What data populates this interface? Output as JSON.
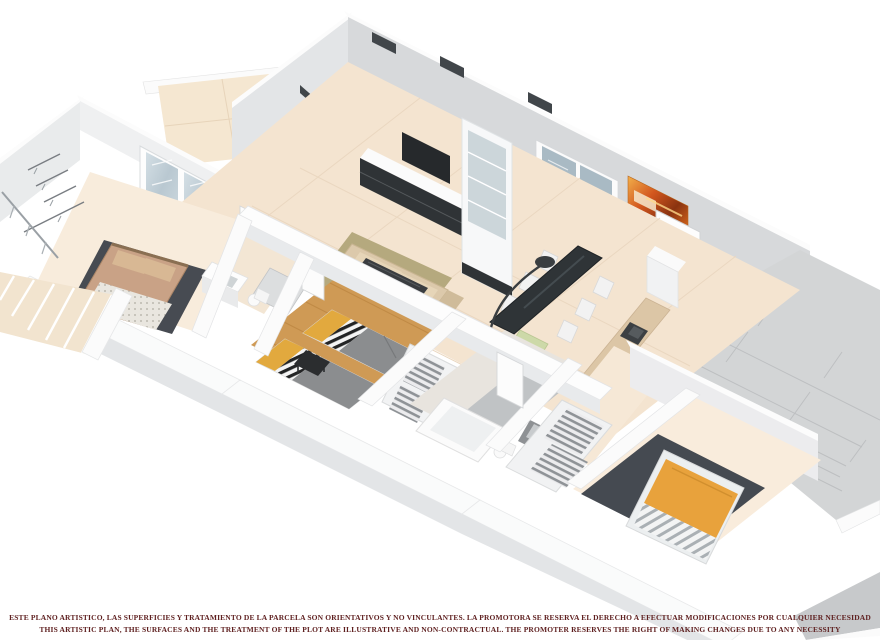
{
  "document": {
    "kind": "3d-isometric-floor-plan-render",
    "background": "#ffffff"
  },
  "disclaimer": {
    "line1_es": "ESTE PLANO ARTISTICO, LAS SUPERFICIES Y TRATAMIENTO DE LA PARCELA SON ORIENTATIVOS Y NO VINCULANTES. LA PROMOTORA SE RESERVA EL DERECHO A EFECTUAR MODIFICACIONES POR CUALQUIER NECESIDAD",
    "line2_en": "THIS ARTISTIC PLAN, THE SURFACES AND THE TREATMENT OF THE PLOT ARE ILLUSTRATIVE AND NON-CONTRACTUAL. THE PROMOTER RESERVES THE RIGHT OF MAKING CHANGES DUE TO ANY NECESSITY",
    "text_color": "#5e1f1f"
  },
  "palette": {
    "wall_face": "#d7d9db",
    "wall_face_light": "#e9ebec",
    "wall_cap": "#fcfcfc",
    "floor_tile_cream": "#f4e4d0",
    "floor_bedroom": "#f8ecdc",
    "floor_wood_orange": "#cf9a55",
    "terrace_gray": "#d3d5d6",
    "rug_dark_gray": "#474b52",
    "duvet_orange": "#e8a23c",
    "pillow_yellow": "#e2a93e",
    "bed_gray": "#8b8d8f",
    "sofa_beige": "#dcc9ab",
    "glass_blue": "#c2cfd7",
    "dark_furniture": "#2f3437",
    "painting_orange": "#d2561e"
  },
  "rooms": [
    {
      "name": "living-dining-kitchen",
      "features": [
        "tv-wall-unit",
        "bookcase",
        "l-sofa",
        "coffee-table",
        "dining-table-6-chairs",
        "arc-lamp",
        "kitchen-counter-sink",
        "entrance-door",
        "orange-painting"
      ]
    },
    {
      "name": "bedroom-1",
      "features": [
        "double-bed",
        "rug",
        "wardrobe-rails",
        "french-doors-to-terrace",
        "ensuite-sink",
        "ensuite-shower",
        "ensuite-toilet"
      ]
    },
    {
      "name": "bedroom-2",
      "features": [
        "single-bed-a",
        "single-bed-b",
        "chevron-blankets",
        "desk",
        "closet-shelves",
        "wood-floor"
      ]
    },
    {
      "name": "family-bathroom",
      "features": [
        "bathtub",
        "sink",
        "toilet",
        "gray-tiled-zone"
      ]
    },
    {
      "name": "master-bedroom",
      "features": [
        "double-bed-orange",
        "rug",
        "wall-tv"
      ]
    },
    {
      "name": "hallway",
      "features": [
        "doors"
      ]
    }
  ],
  "outdoor": [
    {
      "name": "terrace-top-left",
      "floor": "beige-tiles"
    },
    {
      "name": "terrace-right",
      "floor": "gray-large-tiles"
    },
    {
      "name": "stairs-bottom-left",
      "features": [
        "steps",
        "railing"
      ]
    },
    {
      "name": "entrance-porch",
      "features": [
        "landing"
      ]
    },
    {
      "name": "slab-corner-bottom-right",
      "floor": "gray"
    }
  ]
}
